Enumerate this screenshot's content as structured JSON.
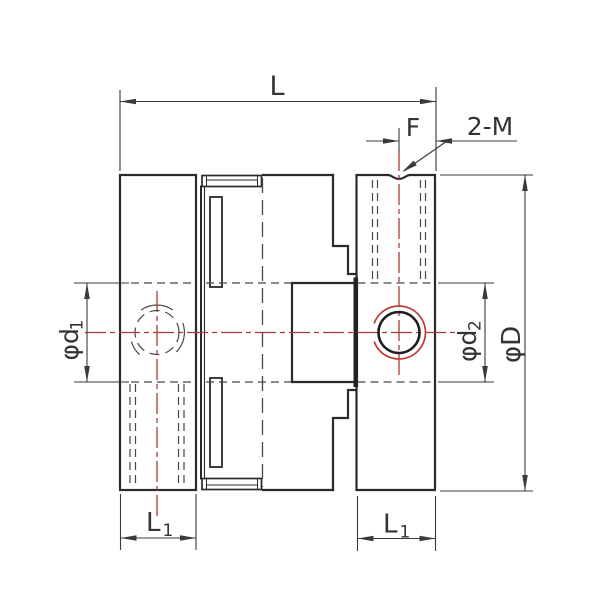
{
  "drawing": {
    "background": "#ffffff",
    "colors": {
      "outline": "#2b2b2b",
      "hidden": "#474747",
      "dimension": "#3a3a3a",
      "text": "#333333",
      "centerline": "#a93a35",
      "thread": "#c03a32",
      "contact_fill": "#232323",
      "circle": "#1e1e1e"
    },
    "labels": {
      "total_length": "L",
      "setscrew_offset": "F",
      "setscrew_callout": "2-M",
      "bore_left_symbol": "φd",
      "bore_left_sub": "1",
      "bore_right_symbol": "φd",
      "bore_right_sub": "2",
      "outer_diameter": "φD",
      "hub_length_left": "L",
      "hub_length_left_sub": "1",
      "hub_length_right": "L",
      "hub_length_right_sub": "1"
    }
  }
}
